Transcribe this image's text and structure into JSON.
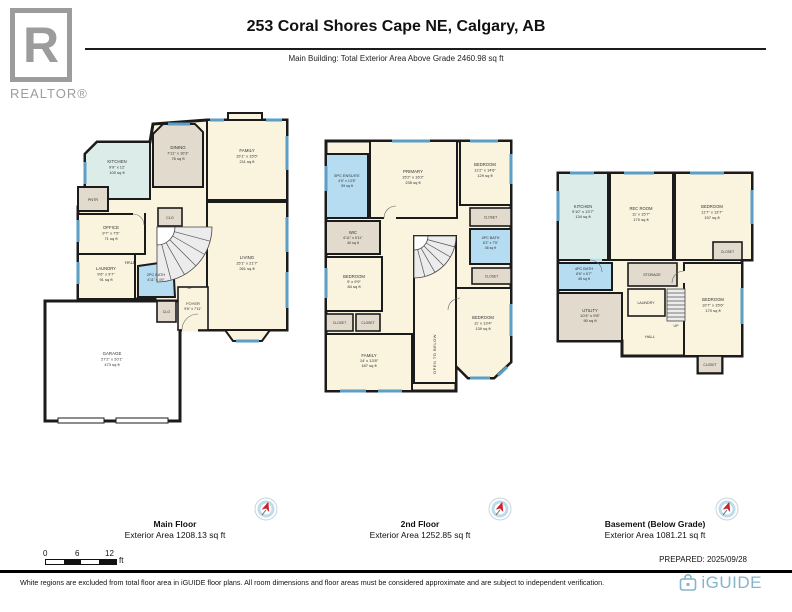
{
  "header": {
    "title": "253 Coral Shores Cape NE, Calgary, AB",
    "subtitle": "Main Building: Total Exterior Area Above Grade 2460.98 sq ft",
    "logo_r": "R",
    "logo_text": "REALTOR®"
  },
  "floors": [
    {
      "caption": "Main Floor",
      "area_label": "Exterior Area 1208.13 sq ft",
      "rooms": {
        "kitchen": {
          "name": "KITCHEN",
          "dims": "9'9\" x 12'",
          "area": "100 sq ft"
        },
        "dining": {
          "name": "DINING",
          "dims": "7'11\" x 10'3\"",
          "area": "76 sq ft"
        },
        "family": {
          "name": "FAMILY",
          "dims": "15'1\" x 15'5\"",
          "area": "211 sq ft"
        },
        "pantry": {
          "name": "PNTR"
        },
        "office": {
          "name": "OFFICE",
          "dims": "9'7\" x 7'5\"",
          "area": "71 sq ft"
        },
        "closet_hall": {
          "name": "CLO"
        },
        "living": {
          "name": "LIVING",
          "dims": "15'1\" x 21'7\"",
          "area": "261 sq ft"
        },
        "laundry": {
          "name": "LAUNDRY",
          "dims": "9'6\" x 9'7\"",
          "area": "91 sq ft"
        },
        "bath": {
          "name": "2PC BATH",
          "dims": "4'11\" x 4'9\""
        },
        "foyer": {
          "name": "FOYER",
          "dims": "9'6\" x 7'11\""
        },
        "hall": {
          "name": "HALL"
        },
        "up": {
          "name": "UP"
        },
        "closet_foyer": {
          "name": "CLO"
        },
        "garage": {
          "name": "GARAGE",
          "dims": "27'2\" x 20'1\"",
          "area": "473 sq ft"
        }
      }
    },
    {
      "caption": "2nd Floor",
      "area_label": "Exterior Area 1252.85 sq ft",
      "rooms": {
        "ensuite": {
          "name": "5PC ENSUITE",
          "dims": "4'5\" x 13'5\"",
          "area": "59 sq ft"
        },
        "wic": {
          "name": "WIC",
          "dims": "6'11\" x 5'11\"",
          "area": "40 sq ft"
        },
        "bedroom_left": {
          "name": "BEDROOM",
          "dims": "9' x 9'9\"",
          "area": "84 sq ft"
        },
        "closet1": {
          "name": "CLOSET"
        },
        "closet2": {
          "name": "CLOSET"
        },
        "family": {
          "name": "FAMILY",
          "dims": "14' x 13'8\"",
          "area": "187 sq ft"
        },
        "primary": {
          "name": "PRIMARY",
          "dims": "15'2\" x 16'2\"",
          "area": "235 sq ft"
        },
        "bedroom_top": {
          "name": "BEDROOM",
          "dims": "11'2\" x 14'6\"",
          "area": "129 sq ft"
        },
        "closet3": {
          "name": "CLOSET"
        },
        "bath": {
          "name": "4PC BATH",
          "dims": "6'2\" x 7'5\"",
          "area": "46 sq ft"
        },
        "closet4": {
          "name": "CLOSET"
        },
        "bedroom_right": {
          "name": "BEDROOM",
          "dims": "11' x 13'4\"",
          "area": "139 sq ft"
        },
        "open_below": {
          "name": "OPEN TO BELOW"
        }
      }
    },
    {
      "caption": "Basement (Below Grade)",
      "area_label": "Exterior Area 1081.21 sq ft",
      "rooms": {
        "kitchen": {
          "name": "KITCHEN",
          "dims": "9'10\" x 13'7\"",
          "area": "134 sq ft"
        },
        "recroom": {
          "name": "REC ROOM",
          "dims": "11' x 15'7\"",
          "area": "170 sq ft"
        },
        "bedroom_top": {
          "name": "BEDROOM",
          "dims": "11'7\" x 13'7\"",
          "area": "157 sq ft"
        },
        "closet_top": {
          "name": "CLOSET"
        },
        "bath": {
          "name": "4PC BATH",
          "dims": "8'6\" x 5'7\"",
          "area": "45 sq ft"
        },
        "utility": {
          "name": "UTILITY",
          "dims": "10'4\" x 9'8\"",
          "area": "90 sq ft"
        },
        "storage": {
          "name": "STORAGE"
        },
        "laundry": {
          "name": "LAUNDRY"
        },
        "up": {
          "name": "UP"
        },
        "hall": {
          "name": "HALL"
        },
        "bedroom_right": {
          "name": "BEDROOM",
          "dims": "10'7\" x 15'6\"",
          "area": "170 sq ft"
        },
        "closet_bottom": {
          "name": "CLOSET"
        }
      }
    }
  ],
  "scalebar": {
    "zero": "0",
    "six": "6",
    "twelve": "12",
    "unit": "ft"
  },
  "footer": {
    "prepared": "PREPARED: 2025/09/28",
    "disclaimer": "White regions are excluded from total floor area in iGUIDE floor plans. All room dimensions and floor areas must be considered approximate and are subject to independent verification.",
    "brand": "iGUIDE"
  },
  "colors": {
    "room_cream": "#faf3dd",
    "room_tan": "#e2dacc",
    "bath_blue": "#b5dcf1",
    "kitchen_teal": "#dcede9",
    "window_blue": "#5b9ec6",
    "wall_black": "#1b1b1b",
    "brand_blue": "#85b5ca",
    "logo_gray": "#9c9c9c"
  }
}
